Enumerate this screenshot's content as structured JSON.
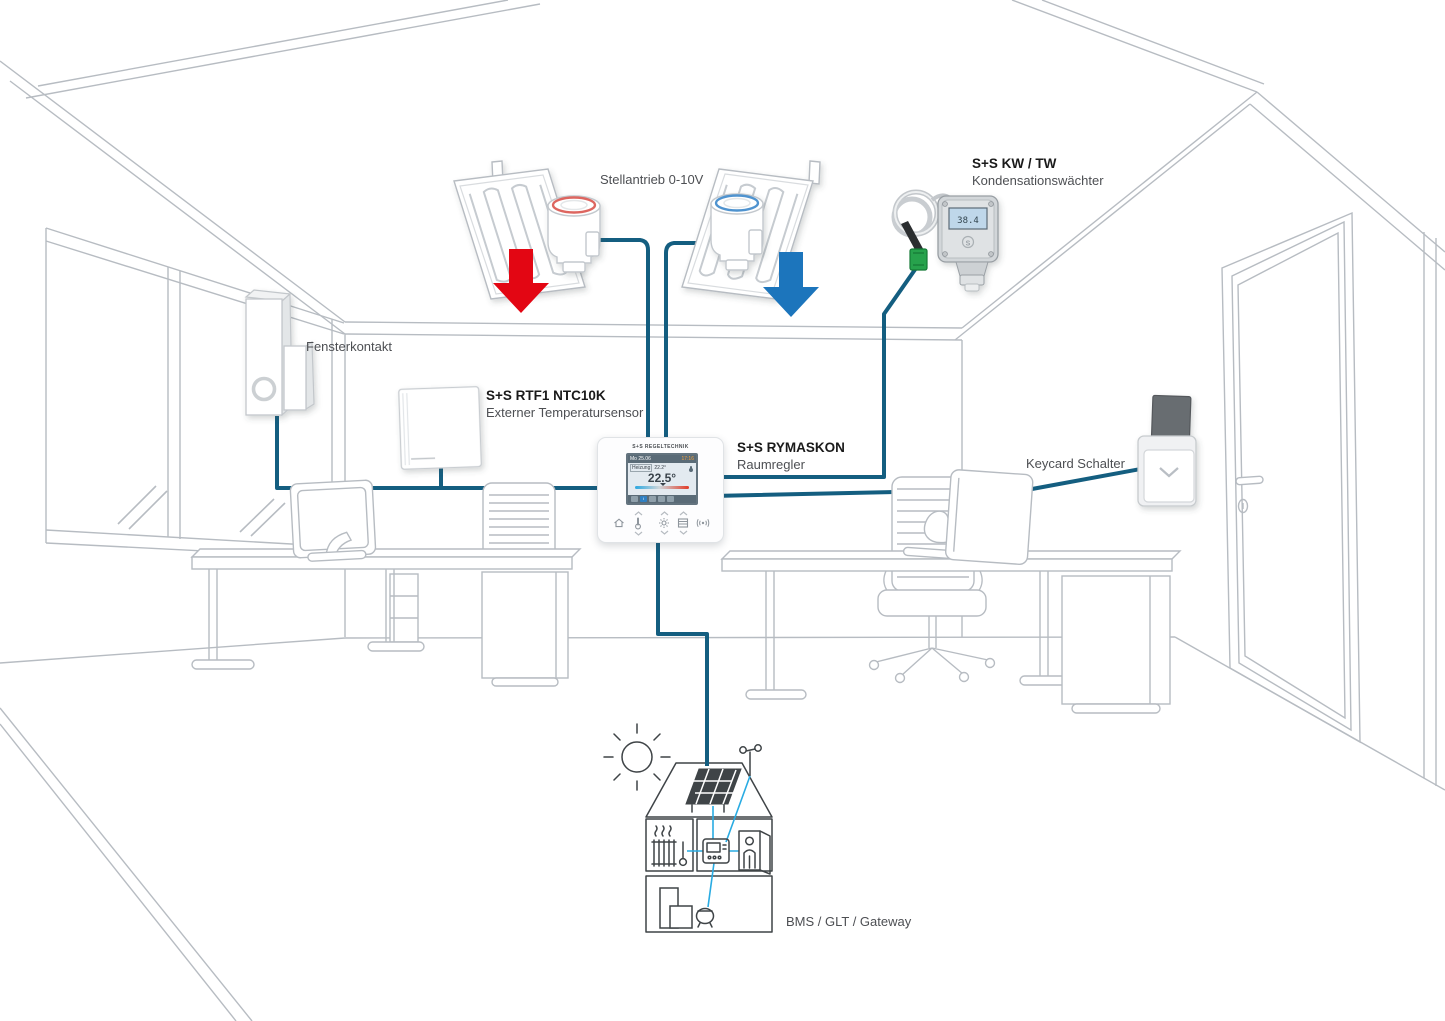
{
  "colors": {
    "wire": "#145E80",
    "arrow_red": "#E30613",
    "arrow_blue": "#1C75BC",
    "cyan": "#29ABE2",
    "line_art": "#B7BCC2",
    "house_ink": "#3F4447",
    "heading": "#1A1A1A",
    "label": "#4D4F53"
  },
  "labels": {
    "stellantrieb": "Stellantrieb 0-10V",
    "fensterkontakt": "Fensterkontakt",
    "keycard": "Keycard Schalter",
    "bms": "BMS / GLT / Gateway"
  },
  "devices": {
    "kw_tw": {
      "title": "S+S KW / TW",
      "subtitle": "Kondensationswächter",
      "display": "38.4"
    },
    "rtf1": {
      "title": "S+S RTF1 NTC10K",
      "subtitle": "Externer Temperatursensor"
    },
    "rymaskon": {
      "title": "S+S RYMASKON",
      "subtitle": "Raumregler"
    }
  },
  "controller": {
    "brand": "S+S REGELTECHNIK",
    "display": {
      "date": "Mo 25.06",
      "time": "17:16",
      "mode": "Heizung",
      "setpoint": "22.2°",
      "temperature": "22.5°"
    },
    "buttons": [
      "home",
      "temperature",
      "light",
      "blinds",
      "signal"
    ]
  }
}
